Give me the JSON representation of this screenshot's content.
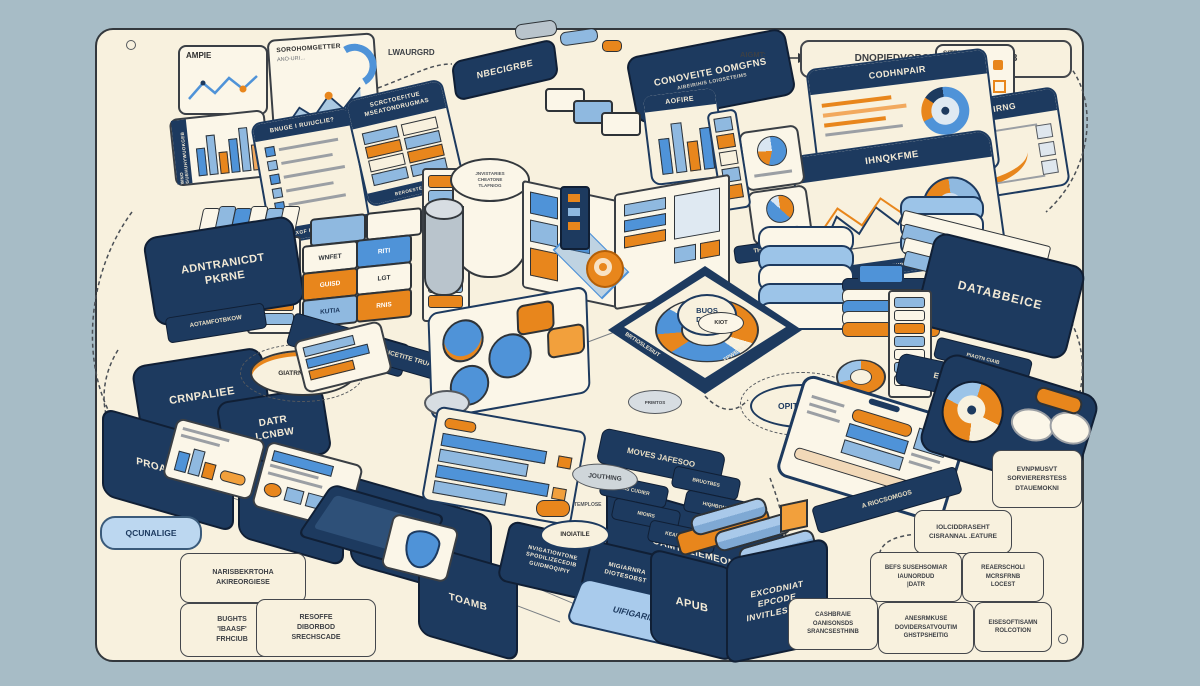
{
  "top": {
    "ampie": "AMPIE",
    "chart_title": "SOROHOMGETTER",
    "chart_sub": "ANO-URI…",
    "lwaurgrd": "LWAURGRD",
    "nbecigrbe": "NBECIGRBE",
    "banner_title": "CONOVEITE OOMGFNS",
    "banner_sub": "AIBEIRIHIS LOIOSETEIMS",
    "aigmt": "AIGMT:",
    "outline_box": "DNOPIEDVORCE MMBEPOOASS3",
    "sitepoint": "SITEPOUNTP",
    "tooioirng": "JOOIOIRNG",
    "codhnpair": "CODHNPAIR",
    "ihnokfme": "IHNQKFME",
    "ihnokfme_footer": "BRATMIBOUIATFYES",
    "theche": "THECHE",
    "aofire": "AOFIRE"
  },
  "panels": {
    "bar_panel_vertical": "WNO GUEHUHYWUOKGEB",
    "list_title": "BNUGE I RUIUCLIE?",
    "list_footer": "EXGF BERSCETHNIP",
    "table_title_1": "SCRCTOEFITUE",
    "table_title_2": "MSEATONDRUGMAS",
    "table_footer": "BEROESTEDOUE"
  },
  "left": {
    "adnt_1": "ADNTRANICDT",
    "adnt_2": "PKRNE",
    "aotam": "AOTAMFOTBKOW",
    "crnpaliee": "CRNPALIEE",
    "datr_1": "DATR",
    "datr_2": "LCNBW",
    "giatr": "GIATRNINGTON",
    "crates": [
      "WNFET",
      "RITI",
      "GUISD",
      "LGT",
      "KUTIA",
      "RNIS"
    ],
    "edge_1a": "MSTETSIOIAL",
    "edge_1b": "ONSIDBATATK",
    "edge_2": "INCETITE TRUA BRR"
  },
  "center": {
    "cyl": [
      "JNVISTARIES",
      "CHEATONE",
      "TLAFNIOG"
    ],
    "donut_1": "BUOS",
    "donut_2": "DOUP",
    "donut_edge_left": "BRTIOSLESIUT",
    "donut_edge_right": "FPWBAILS",
    "opithermt": "OPITHERMT",
    "primtos": "PRIMTOS",
    "kiot": "KIOT"
  },
  "right": {
    "databbeice": "DATABBEICE",
    "db_strip": "PIAOTN CIAIB",
    "eoosticr": "EOOSTICR"
  },
  "bottom": {
    "segments": [
      "PROAIROVE",
      "DHOGA",
      "PAVGEMIST"
    ],
    "seg_big_1": "OAMTDLIEMEONE",
    "seg_big_2": "UVZLITBE",
    "toamb": "TOAMB",
    "qcunalige": "QCUNALIGE",
    "moves": "MOVES JAFESOO",
    "moves_bars": [
      "AMS CUDIER",
      "BRUOTBES",
      "MIOIRS",
      "HIQHBOMOS",
      "KEAPTEMERT"
    ],
    "riocs": "A RIOCSOMGOS",
    "nav_box": [
      "NVIGATIONTONE",
      "SPODILIZECEDIB",
      "GUIDMOQIPIY"
    ],
    "mig_box": [
      "MIGIARNRA",
      "DIOTESOBST"
    ],
    "jouthing": "JOUTHING",
    "templose": "TEMPLOSE",
    "inoiatile": "INOIATILE",
    "uifig": "UIFIGARIINEDE",
    "apub": "APUB",
    "excod": [
      "EXCODNIAT",
      "EPCODE",
      "INVITLESTOG"
    ]
  },
  "notes": {
    "naris": [
      "NARISBEKRTOHA",
      "AKIREORGIESE"
    ],
    "bughts": [
      "BUGHTS",
      "'IBAASF'",
      "FRHCIUB"
    ],
    "resoffe": [
      "RESOFFE",
      "DIBORBOD",
      "SRECHSCADE"
    ],
    "cashbraie": [
      "CASHBRAIE",
      "OANISONSDS",
      "SRANCSESTHINB"
    ],
    "anesrmkuse": [
      "ANESRMKUSE",
      "DOVIDERSATVOUTIM",
      "GHSTPSHEITIG"
    ],
    "eisesoftisamn": [
      "EISESOFTISAMN",
      "ROLCOTION"
    ],
    "befs": [
      "BEFS SUSEHSOMIAR",
      "IAUNORDUD",
      "|DATR"
    ],
    "reaerscholi": [
      "REAERSCHOLI",
      "MCRSFRNB",
      "LOCEST"
    ],
    "iolcid": [
      "IOLCIDDRASEHT",
      "CISRANNAL .EATURE"
    ],
    "evnpmusvt": [
      "EVNPMUSVT",
      "SORVIERERSTESS",
      "DTAUEMOKNI"
    ]
  }
}
